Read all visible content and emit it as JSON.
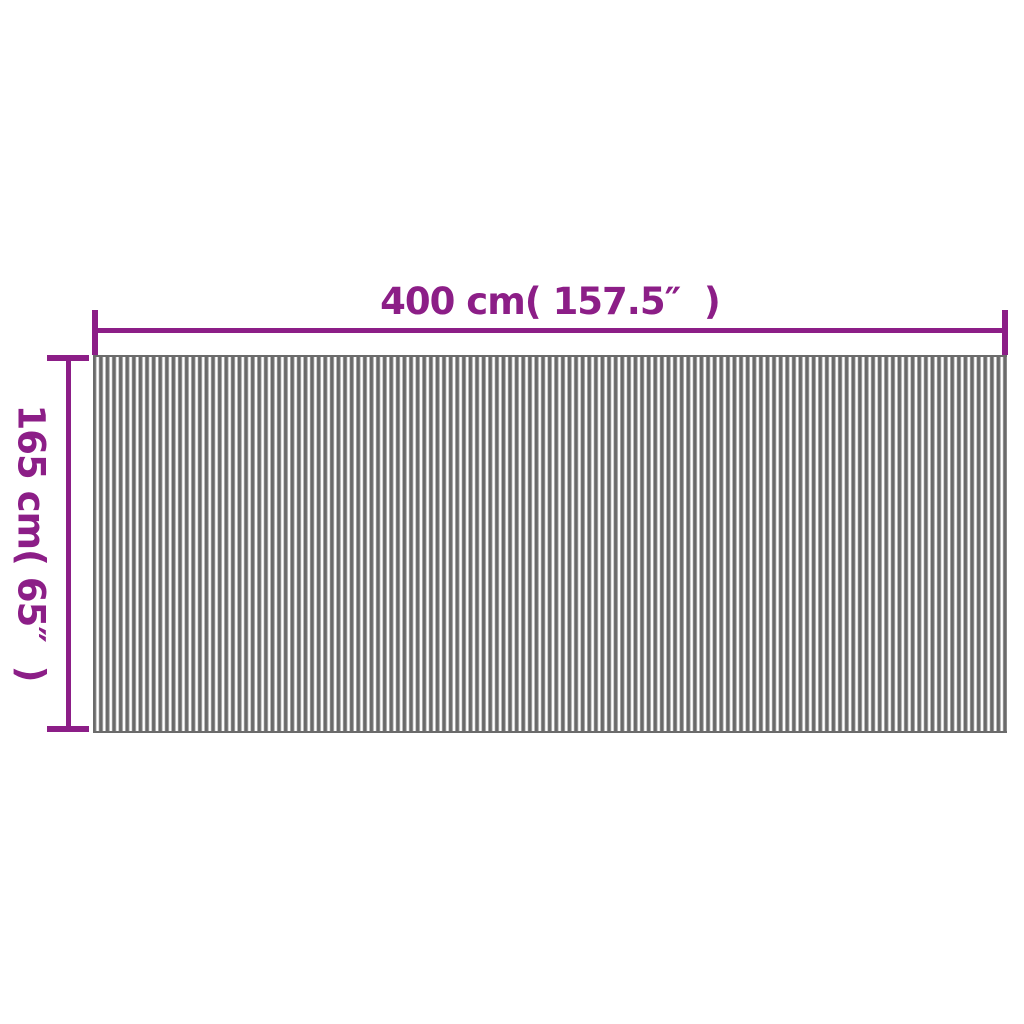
{
  "diagram": {
    "description": "Dimension diagram of a vertically striped divider panel",
    "dimensions": {
      "width": {
        "label": "400 cm( 157.5″  )"
      },
      "height": {
        "label": "165 cm( 65″  )"
      }
    }
  },
  "colors": {
    "dimension": "#8c1e87",
    "background": "#ffffff",
    "stripe-dark": "#6a6a6a",
    "stripe-mid": "#a2a2a2",
    "stripe-light": "#ffffff",
    "panel-edge": "#6b6b6b"
  }
}
